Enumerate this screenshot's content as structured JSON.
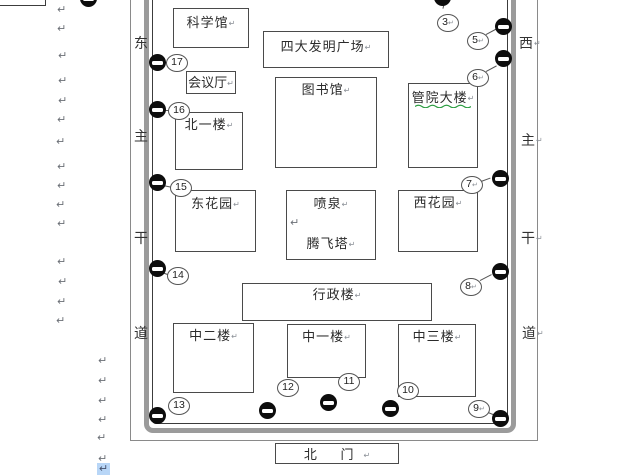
{
  "document": {
    "app_context": "word-processor page with drawing",
    "paragraph_mark": "↵"
  },
  "map": {
    "roads": {
      "left": {
        "name": "东主干道",
        "chars": [
          "东",
          "主",
          "干",
          "道"
        ]
      },
      "right": {
        "name": "西主干道",
        "chars": [
          "西",
          "主",
          "干",
          "道"
        ]
      }
    },
    "buildings": {
      "science_hall": {
        "label": "科学馆"
      },
      "plaza": {
        "label": "四大发明广场"
      },
      "conference_hall": {
        "label": "会议厅"
      },
      "library": {
        "label": "图书馆"
      },
      "mgmt_building": {
        "label": "管院大楼"
      },
      "north_building_1": {
        "label": "北一楼"
      },
      "east_garden": {
        "label": "东花园"
      },
      "fountain": {
        "label": "喷泉"
      },
      "tengfei_tower": {
        "label": "腾飞塔"
      },
      "west_garden": {
        "label": "西花园"
      },
      "admin_building": {
        "label": "行政楼"
      },
      "middle_building_2": {
        "label": "中二楼"
      },
      "middle_building_1": {
        "label": "中一楼"
      },
      "middle_building_3": {
        "label": "中三楼"
      },
      "north_gate": {
        "label": "北 门"
      }
    },
    "callouts": {
      "n3": "3",
      "n5": "5",
      "n6": "6",
      "n7": "7",
      "n8": "8",
      "n9": "9",
      "n10": "10",
      "n11": "11",
      "n12": "12",
      "n13": "13",
      "n14": "14",
      "n15": "15",
      "n16": "16",
      "n17": "17"
    },
    "colors": {
      "wall_border_gray": "#9b9b9b",
      "line_black": "#3c3c3c",
      "spellcheck_green": "#2f9e44",
      "selection_blue": "#b8d6f7",
      "no_entry_black": "#0d0d0d"
    }
  }
}
